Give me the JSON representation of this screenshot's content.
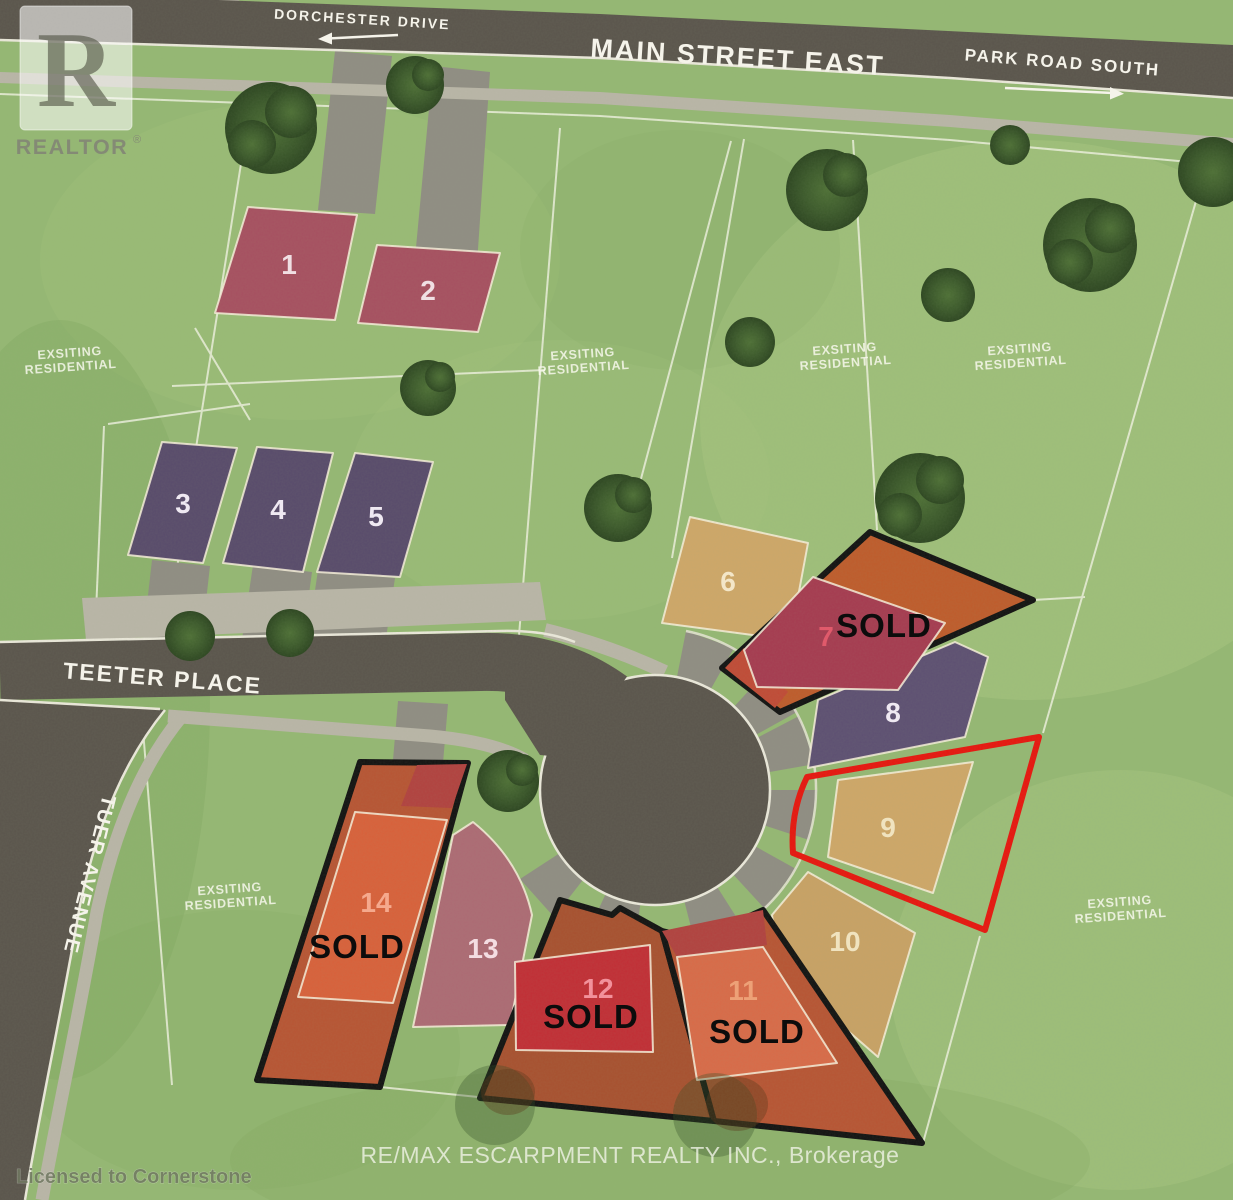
{
  "title": "Teeter Place subdivision lot map",
  "streets": {
    "main_street": "MAIN STREET EAST",
    "dorchester": "DORCHESTER DRIVE",
    "park_road": "PARK ROAD SOUTH",
    "teeter_place": "TEETER PLACE",
    "tuer_avenue": "TUER AVENUE"
  },
  "surrounding_label": {
    "line1": "EXSITING",
    "line2": "RESIDENTIAL"
  },
  "sold_text": "SOLD",
  "lots": [
    {
      "number": "1",
      "status": "available",
      "fill": "#a74f60"
    },
    {
      "number": "2",
      "status": "available",
      "fill": "#a74f60"
    },
    {
      "number": "3",
      "status": "available",
      "fill": "#584a6b"
    },
    {
      "number": "4",
      "status": "available",
      "fill": "#584a6b"
    },
    {
      "number": "5",
      "status": "available",
      "fill": "#584a6b"
    },
    {
      "number": "6",
      "status": "available",
      "fill": "#cfa768"
    },
    {
      "number": "7",
      "status": "sold",
      "fill": "#a63a50"
    },
    {
      "number": "8",
      "status": "available",
      "fill": "#5d4f72"
    },
    {
      "number": "9",
      "status": "available",
      "fill": "#cfa768",
      "highlight": "#e8150e"
    },
    {
      "number": "10",
      "status": "available",
      "fill": "#c9a265"
    },
    {
      "number": "11",
      "status": "sold",
      "fill": "#d96a48"
    },
    {
      "number": "12",
      "status": "sold",
      "fill": "#c22d35"
    },
    {
      "number": "13",
      "status": "available",
      "fill": "#ad6a74"
    },
    {
      "number": "14",
      "status": "sold",
      "fill": "#d9603a"
    }
  ],
  "branding": {
    "realtor_logo_letter": "R",
    "realtor_logo_text": "REALTOR",
    "registered_mark": "®",
    "license_text": "Licensed to Cornerstone",
    "brokerage_text": "RE/MAX ESCARPMENT REALTY INC., Brokerage"
  },
  "palette": {
    "grass": "#95b873",
    "road": "#5a544c",
    "driveway": "#908d83",
    "sidewalk": "#bab6a8",
    "parcel_line": "#f2f4e4",
    "sold_outline": "#111111",
    "highlight_outline": "#e8150e",
    "street_text": "#f5f3ea",
    "tree": "#3c5a2b"
  }
}
